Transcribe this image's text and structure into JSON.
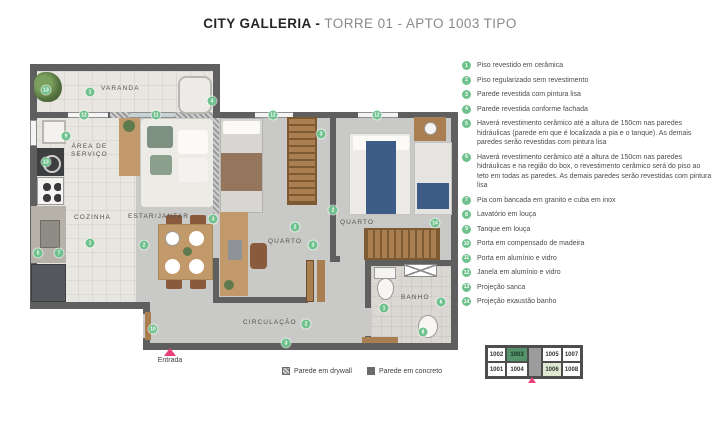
{
  "title": {
    "brand": "CITY GALLERIA - ",
    "suffix": "TORRE 01 - APTO 1003 TIPO"
  },
  "colors": {
    "marker_green": "#6fc28d",
    "accent_pink": "#e8417e",
    "wall_dark": "#5f5f5f",
    "keyplan_highlight": "#55946a",
    "keyplan_secondary": "#dfe9d2"
  },
  "legend": {
    "items": [
      {
        "num": "1",
        "text": "Piso revestido em cerâmica"
      },
      {
        "num": "2",
        "text": "Piso regularizado sem revestimento"
      },
      {
        "num": "3",
        "text": "Parede revestida com pintura lisa"
      },
      {
        "num": "4",
        "text": "Parede revestida conforme fachada"
      },
      {
        "num": "5",
        "text": "Haverá revestimento cerâmico até a altura de 150cm nas paredes hidráulicas (parede em que é localizada a pia e o tanque). As demais paredes serão revestidas com pintura lisa"
      },
      {
        "num": "6",
        "text": "Haverá revestimento cerâmico até a altura de 150cm nas paredes hidráulicas e na região do box, o revestimento cerâmico será do piso ao teto em todas as paredes. As demais paredes serão revestidas com pintura lisa"
      },
      {
        "num": "7",
        "text": "Pia com bancada em granito e cuba em inox"
      },
      {
        "num": "8",
        "text": "Lavatório em louça"
      },
      {
        "num": "9",
        "text": "Tanque em louça"
      },
      {
        "num": "10",
        "text": "Porta em compensado de madeira"
      },
      {
        "num": "11",
        "text": "Porta em alumínio e vidro"
      },
      {
        "num": "12",
        "text": "Janela em alumínio e vidro"
      },
      {
        "num": "13",
        "text": "Projeção sanca"
      },
      {
        "num": "14",
        "text": "Projeção exaustão banho"
      }
    ]
  },
  "floorplan": {
    "room_labels": [
      {
        "text": "VARANDA",
        "x": 101,
        "y": 85
      },
      {
        "text": "ÁREA DE\nSERVIÇO",
        "x": 71,
        "y": 143
      },
      {
        "text": "COZINHA",
        "x": 74,
        "y": 214
      },
      {
        "text": "ESTAR/JANTAR",
        "x": 128,
        "y": 213
      },
      {
        "text": "QUARTO",
        "x": 268,
        "y": 238
      },
      {
        "text": "QUARTO",
        "x": 340,
        "y": 219
      },
      {
        "text": "BANHO",
        "x": 401,
        "y": 294
      },
      {
        "text": "CIRCULAÇÃO",
        "x": 243,
        "y": 319
      }
    ],
    "markers": [
      {
        "n": "13",
        "x": 46,
        "y": 90
      },
      {
        "n": "1",
        "x": 90,
        "y": 92
      },
      {
        "n": "4",
        "x": 212,
        "y": 101
      },
      {
        "n": "12",
        "x": 84,
        "y": 115
      },
      {
        "n": "11",
        "x": 156,
        "y": 115
      },
      {
        "n": "12",
        "x": 273,
        "y": 115
      },
      {
        "n": "12",
        "x": 377,
        "y": 115
      },
      {
        "n": "9",
        "x": 66,
        "y": 136
      },
      {
        "n": "13",
        "x": 46,
        "y": 162
      },
      {
        "n": "3",
        "x": 321,
        "y": 134
      },
      {
        "n": "2",
        "x": 333,
        "y": 210
      },
      {
        "n": "14",
        "x": 435,
        "y": 223
      },
      {
        "n": "2",
        "x": 295,
        "y": 227
      },
      {
        "n": "3",
        "x": 313,
        "y": 245
      },
      {
        "n": "3",
        "x": 213,
        "y": 219
      },
      {
        "n": "2",
        "x": 144,
        "y": 245
      },
      {
        "n": "1",
        "x": 90,
        "y": 243
      },
      {
        "n": "5",
        "x": 38,
        "y": 253
      },
      {
        "n": "7",
        "x": 59,
        "y": 253
      },
      {
        "n": "10",
        "x": 153,
        "y": 329
      },
      {
        "n": "2",
        "x": 306,
        "y": 324
      },
      {
        "n": "3",
        "x": 286,
        "y": 343
      },
      {
        "n": "1",
        "x": 384,
        "y": 308
      },
      {
        "n": "6",
        "x": 441,
        "y": 302
      },
      {
        "n": "8",
        "x": 423,
        "y": 332
      }
    ],
    "entrance_label": "Entrada"
  },
  "wall_legend": {
    "drywall": "Parede em drywall",
    "concrete": "Parede em concreto"
  },
  "keyplan": {
    "units": [
      {
        "id": "1002",
        "col": 1,
        "row": 1,
        "state": "normal"
      },
      {
        "id": "1003",
        "col": 2,
        "row": 1,
        "state": "primary"
      },
      {
        "id": "1005",
        "col": 4,
        "row": 1,
        "state": "normal"
      },
      {
        "id": "1007",
        "col": 5,
        "row": 1,
        "state": "normal"
      },
      {
        "id": "1001",
        "col": 1,
        "row": 2,
        "state": "normal"
      },
      {
        "id": "1004",
        "col": 2,
        "row": 2,
        "state": "normal"
      },
      {
        "id": "1006",
        "col": 4,
        "row": 2,
        "state": "secondary"
      },
      {
        "id": "1008",
        "col": 5,
        "row": 2,
        "state": "normal"
      }
    ]
  }
}
